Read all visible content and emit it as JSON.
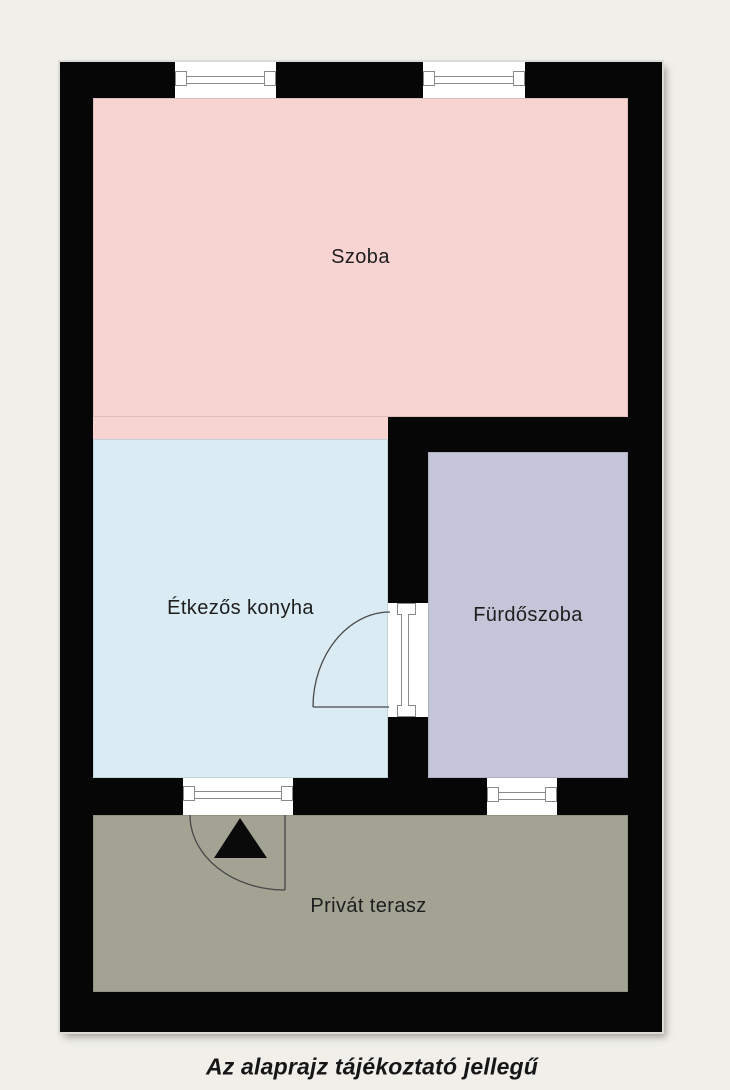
{
  "page": {
    "background_color": "#f0efea",
    "caption": "Az alaprajz tájékoztató jellegű"
  },
  "floor_plan": {
    "wall_color": "#060606",
    "rooms": {
      "szoba": {
        "label": "Szoba",
        "color": "#f7d4d1"
      },
      "konyha": {
        "label": "Étkezős konyha",
        "color": "#daebf3"
      },
      "furdoszoba": {
        "label": "Fürdőszoba",
        "color": "#c5c5d9"
      },
      "terasz": {
        "label": "Privát terasz",
        "color": "#a2a393"
      }
    },
    "features": {
      "top_windows": 2,
      "bathroom_window": 1,
      "terrace_door": 1,
      "bathroom_door": 1,
      "entrance_marker": "black triangle arrow pointing up"
    }
  }
}
